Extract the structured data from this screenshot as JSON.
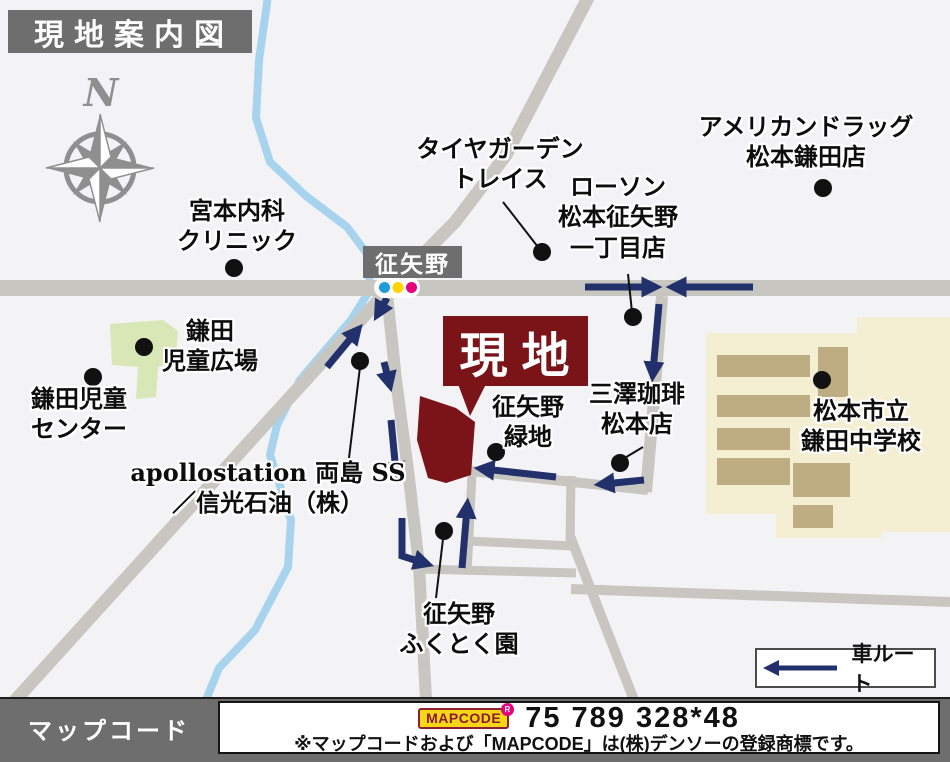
{
  "title": "現地案内図",
  "compass": {
    "north_label": "N"
  },
  "intersection": {
    "name": "征矢野"
  },
  "site": {
    "label": "現地"
  },
  "pois": {
    "miyamoto_clinic": {
      "line1": "宮本内科",
      "line2": "クリニック"
    },
    "tire_garden": {
      "line1": "タイヤガーデン",
      "line2": "トレイス"
    },
    "lawson": {
      "line1": "ローソン",
      "line2": "松本征矢野",
      "line3": "一丁目店"
    },
    "american_drug": {
      "line1": "アメリカンドラッグ",
      "line2": "松本鎌田店"
    },
    "kamada_plaza": {
      "line1": "鎌田",
      "line2": "児童広場"
    },
    "kamada_center": {
      "line1": "鎌田児童",
      "line2": "センター"
    },
    "soyano_green": {
      "line1": "征矢野",
      "line2": "緑地"
    },
    "misawa_coffee": {
      "line1": "三澤珈琲",
      "line2": "松本店"
    },
    "kamada_junior_high": {
      "line1": "松本市立",
      "line2": "鎌田中学校"
    },
    "apollostation": {
      "line1": "apollostation 両島 SS",
      "line2": "／信光石油（株）"
    },
    "fukutokuen": {
      "line1": "征矢野",
      "line2": "ふくとく園"
    }
  },
  "legend": {
    "car_route": "車ルート"
  },
  "mapcode": {
    "bar_label": "マップコード",
    "logo": "MAPCODE",
    "registered_mark": "R",
    "code": "75 789 328*48",
    "trademark_note": "※マップコードおよび「MAPCODE」は(株)デンソーの登録商標です。"
  },
  "colors": {
    "route_navy": "#22306b",
    "site_red": "#7a1418",
    "road_gray": "#c8c6c1",
    "river_blue": "#a7d3ee",
    "park_green": "#d9e7b6",
    "school_beige": "#f4eed3",
    "building_tan": "#beac83",
    "banner_gray": "#6e6e6e",
    "signal_blue": "#1e9cd8",
    "signal_yellow": "#ffd400",
    "signal_magenta": "#e5017d",
    "mapcode_yellow": "#f7d618"
  }
}
